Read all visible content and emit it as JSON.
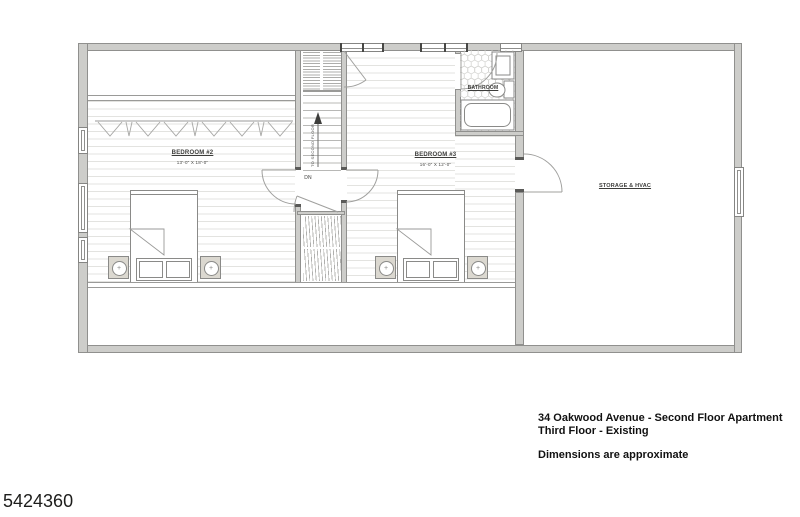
{
  "document": {
    "plan_labels": {
      "bedroom2_name": "BEDROOM #2",
      "bedroom2_dims": "13'-0\" X 18'-0\"",
      "bedroom3_name": "BEDROOM #3",
      "bedroom3_dims": "16'-0\" X 12'-0\"",
      "bathroom_name": "BATHROOM",
      "storage_name": "STORAGE & HVAC",
      "stair_down": "DN",
      "stair_direction": "TO SECOND FLOOR"
    },
    "annotation": {
      "line1": "34 Oakwood Avenue - Second Floor Apartment",
      "line2": "Third Floor - Existing",
      "note": "Dimensions are approximate"
    },
    "corner_number": "5424360",
    "colors": {
      "wall_fill": "#cdcdca",
      "wall_line": "#8f8f8d",
      "floor_line": "#e3e3e0",
      "ink": "#3c3c3a",
      "paper": "#ffffff"
    }
  }
}
